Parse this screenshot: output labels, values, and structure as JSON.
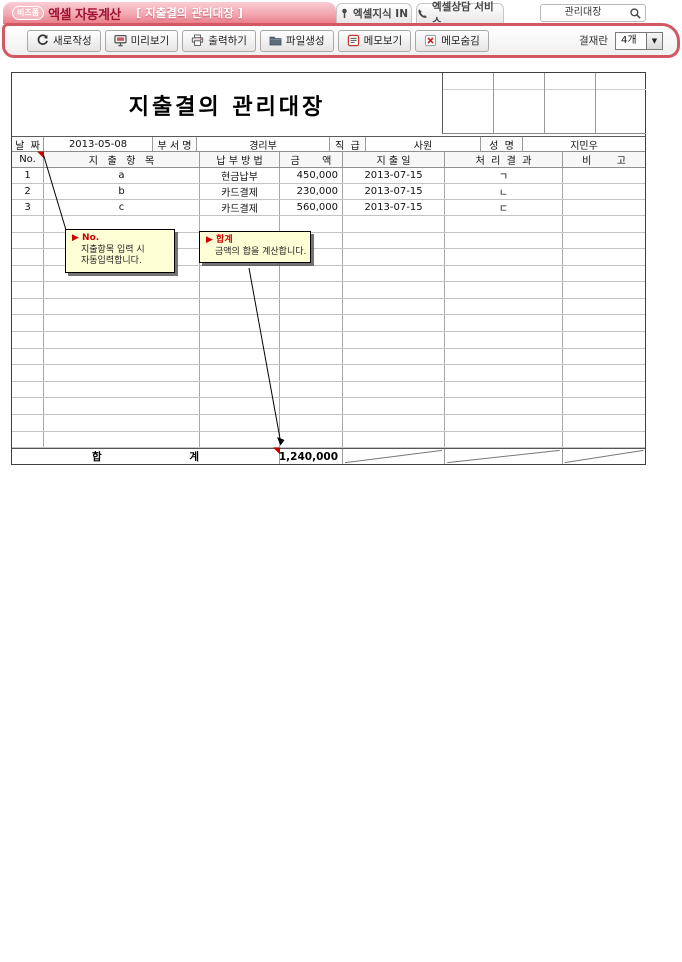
{
  "header": {
    "logo_badge": "비즈폼",
    "logo_title": "엑셀 자동계산",
    "doc_tag": "[ 지출결의 관리대장 ]",
    "tabs": [
      {
        "label": "엑셀지식 IN"
      },
      {
        "label": "엑셀상담 서비스"
      }
    ],
    "search_value": "관리대장"
  },
  "toolbar": {
    "buttons": [
      {
        "label": "새로작성"
      },
      {
        "label": "미리보기"
      },
      {
        "label": "출력하기"
      },
      {
        "label": "파일생성"
      },
      {
        "label": "메모보기"
      },
      {
        "label": "메모숨김"
      }
    ],
    "approval_label": "결재란",
    "approval_count": "4개"
  },
  "document": {
    "title": "지출결의 관리대장",
    "approval_grid_columns": 4,
    "info": {
      "date_label": "날  짜",
      "date_value": "2013-05-08",
      "dept_label": "부 서 명",
      "dept_value": "경리부",
      "rank_label": "직  급",
      "rank_value": "사원",
      "name_label": "성  명",
      "name_value": "지민우"
    },
    "columns": {
      "no": "No.",
      "item": "지   출   항   목",
      "method": "납 부 방 법",
      "amount": "금       액",
      "date": "지 출 일",
      "result": "처  리  결  과",
      "note": "비        고"
    },
    "rows": [
      {
        "no": "1",
        "item": "a",
        "method": "현금납부",
        "amount": "450,000",
        "date": "2013-07-15",
        "result": "ㄱ",
        "note": ""
      },
      {
        "no": "2",
        "item": "b",
        "method": "카드결제",
        "amount": "230,000",
        "date": "2013-07-15",
        "result": "ㄴ",
        "note": ""
      },
      {
        "no": "3",
        "item": "c",
        "method": "카드결제",
        "amount": "560,000",
        "date": "2013-07-15",
        "result": "ㄷ",
        "note": ""
      }
    ],
    "empty_row_count": 14,
    "total": {
      "label": "합                        계",
      "amount": "1,240,000"
    }
  },
  "memos": [
    {
      "title": "▶ No.",
      "lines": [
        "지출항목 입력 시",
        "자동입력합니다."
      ]
    },
    {
      "title": "▶ 합계",
      "lines": [
        "금액의 합을 계산합니다."
      ]
    }
  ],
  "colors": {
    "toolbar_border": "#d25963",
    "header_pink": "#f3a8b2",
    "logo_red": "#9e1330",
    "memo_bg": "#ffffd6",
    "indicator_red": "#cc0000"
  }
}
